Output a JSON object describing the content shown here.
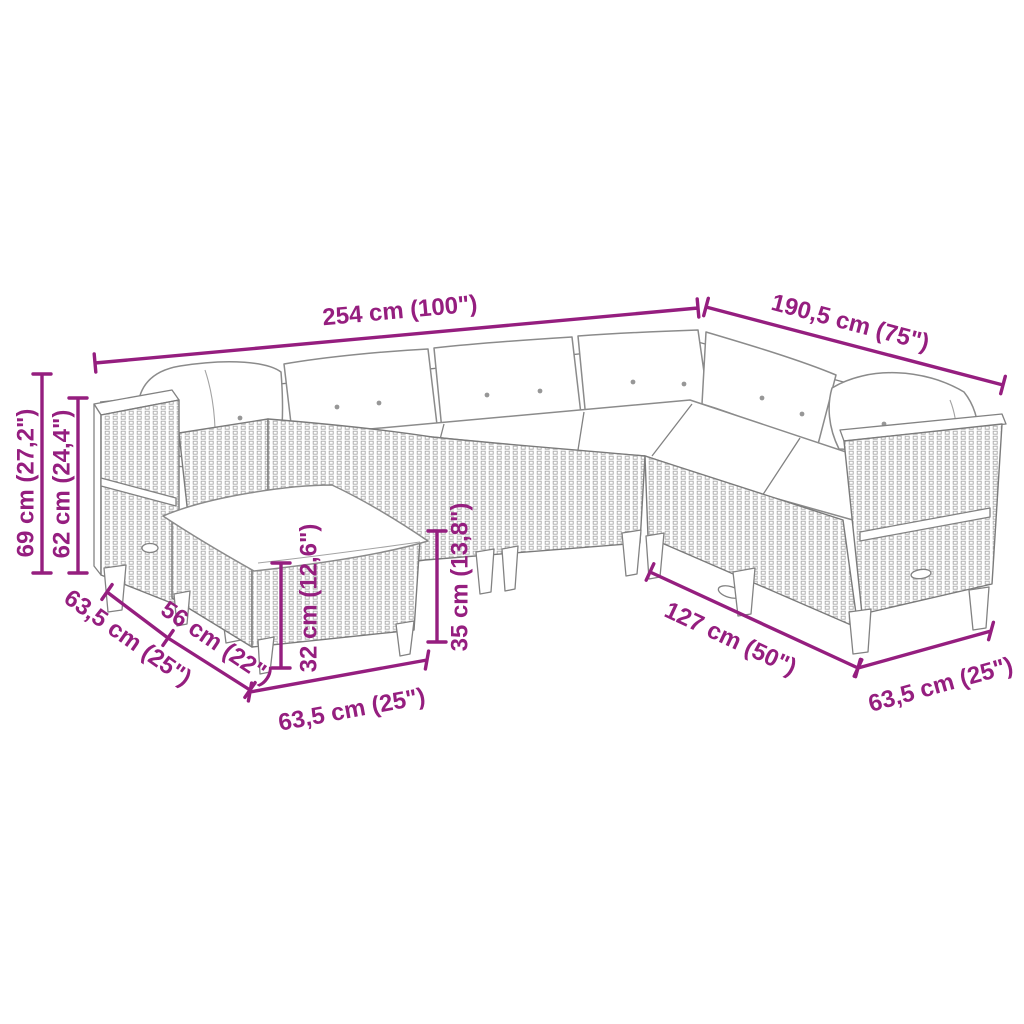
{
  "diagram": {
    "background_color": "#ffffff",
    "accent_color": "#951e7f",
    "artwork_line_color": "#828282",
    "illustration": "l-shaped-rattan-garden-sofa-set-with-footstool",
    "labels": {
      "overall_width": "254 cm (100\")",
      "overall_depth": "190,5 cm (75\")",
      "total_height": "69 cm (27,2\")",
      "back_height": "62 cm (24,4\")",
      "left_module_depth": "63,5 cm (25\")",
      "footstool_depth": "56 cm (22\")",
      "footstool_width": "63,5 cm (25\")",
      "seat_height": "32 cm (12,6\")",
      "base_height": "35 cm (13,8\")",
      "right_wing_width": "127 cm (50\")",
      "right_module_depth": "63,5 cm (25\")"
    }
  }
}
